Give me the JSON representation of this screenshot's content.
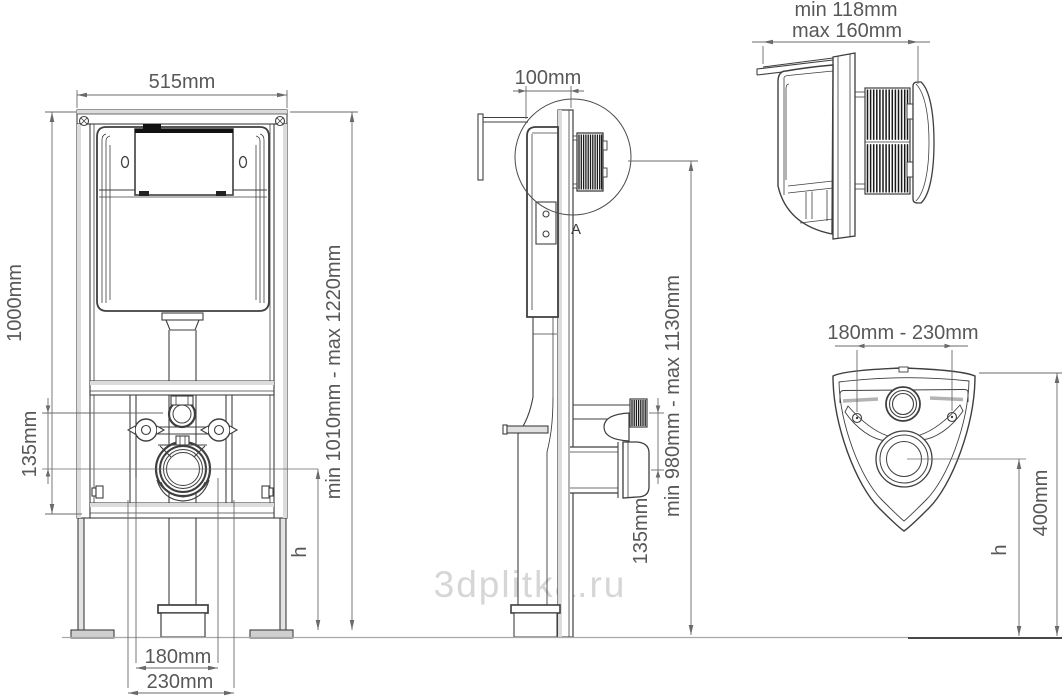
{
  "watermark": {
    "text": "3dplitka.ru"
  },
  "colors": {
    "ink": "#3f3f3f",
    "dim_line": "#6a6a6a",
    "dim_text": "#585858",
    "rail_fill": "#dcdcdc",
    "watermark": "#d6d6d6"
  },
  "front_view": {
    "width": "515mm",
    "height_total": "1000mm",
    "height_range": "min 1010mm - max 1220mm",
    "inlet_to_drain_offset": "135mm",
    "bowl_height_label": "h",
    "drain_spacing": "180mm",
    "outer_spacing": "230mm"
  },
  "side_view": {
    "frame_depth": "100mm",
    "height_range": "min 980mm - max 1130mm",
    "inlet_to_drain_offset": "135mm",
    "detail_marker": "A"
  },
  "detail_view": {
    "depth_min": "min 118mm",
    "depth_max": "max 160mm"
  },
  "plate_view": {
    "hole_spacing_range": "180mm - 230mm",
    "bowl_height_label": "h",
    "drain_height": "400mm"
  }
}
